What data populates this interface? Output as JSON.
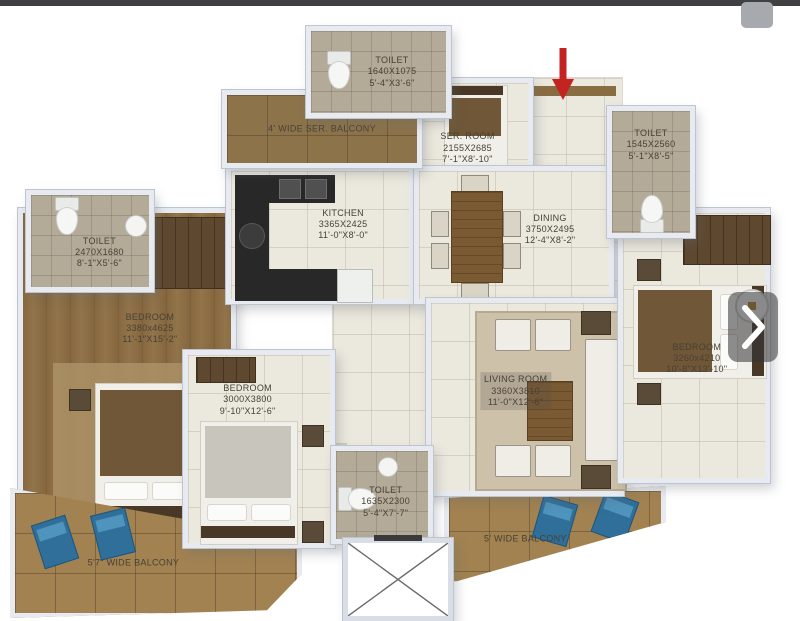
{
  "chrome": {
    "topbar_color": "#404042",
    "scroll_thumb_color": "#a6aaaf"
  },
  "controls": {
    "next_icon": "chevron-right",
    "entry_icon": "arrow-down"
  },
  "palette": {
    "arrow_red": "#c32421",
    "lounge_chair_blue": "#2f6f99",
    "wood_floor": "#87683f",
    "balcony_wood": "#a28251",
    "cream_floor": "#ebe8dd",
    "tile_floor": "#b4aa98",
    "wall": "#e7eaf0",
    "counter_dark": "#282828",
    "table_brown": "#7a5a33"
  },
  "rooms": {
    "toilet_top": {
      "name": "TOILET",
      "mm": "1640X1075",
      "ft": "5'-4\"X3'-6\""
    },
    "ser_balcony": {
      "name": "4' WIDE SER. BALCONY"
    },
    "ser_room": {
      "name": "SER. ROOM",
      "mm": "2155X2685",
      "ft": "7'-1\"X8'-10\""
    },
    "toilet_right": {
      "name": "TOILET",
      "mm": "1545X2560",
      "ft": "5'-1\"X8'-5\""
    },
    "kitchen": {
      "name": "KITCHEN",
      "mm": "3365X2425",
      "ft": "11'-0\"X8'-0\""
    },
    "dining": {
      "name": "DINING",
      "mm": "3750X2495",
      "ft": "12'-4\"X8'-2\""
    },
    "toilet_left": {
      "name": "TOILET",
      "mm": "2470X1680",
      "ft": "8'-1\"X5'-6\""
    },
    "bedroom_left": {
      "name": "BEDROOM",
      "mm": "3380x4625",
      "ft": "11'-1\"X15'-2\""
    },
    "bedroom_mid": {
      "name": "BEDROOM",
      "mm": "3000X3800",
      "ft": "9'-10\"X12'-6\""
    },
    "living_room": {
      "name": "LIVING ROOM",
      "mm": "3360X3810",
      "ft": "11'-0\"X12'-6\""
    },
    "bedroom_right": {
      "name": "BEDROOM",
      "mm": "3260x4210",
      "ft": "10'-8\"X13'-10\""
    },
    "toilet_bottom": {
      "name": "TOILET",
      "mm": "1635X2300",
      "ft": "5'-4\"X7'-7\""
    },
    "balcony_left": {
      "name": "5'7\" WIDE BALCONY"
    },
    "balcony_right": {
      "name": "5' WIDE BALCONY"
    }
  }
}
